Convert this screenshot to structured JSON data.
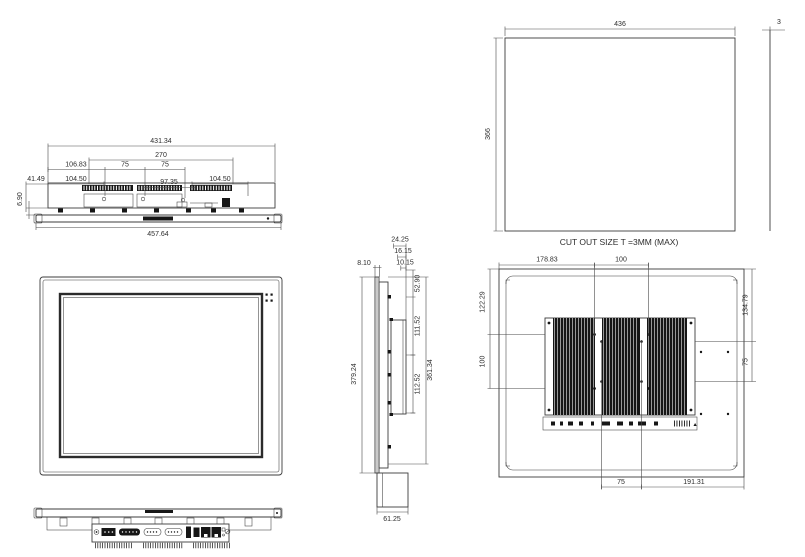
{
  "drawing": {
    "kind": "panel-pc-dimension-drawing",
    "units": "mm",
    "line_color": "#3c3c3c",
    "dark_fill": "#161616",
    "background": "#ffffff"
  },
  "views": {
    "top": {
      "dims": {
        "body_width": "431.34",
        "mount_span": "270",
        "offset_left": "106.83",
        "pitch_a": "75",
        "pitch_b": "75",
        "edge_left": "41.49",
        "seg_left": "104.50",
        "seg_mid": "97.35",
        "seg_right": "104.50",
        "lip": "6.90",
        "overall_width": "457.64"
      }
    },
    "cutout": {
      "caption": "CUT OUT SIZE T =3MM (MAX)",
      "dims": {
        "width": "436",
        "height": "366",
        "thickness": "3"
      }
    },
    "side": {
      "dims": {
        "depth_a": "24.25",
        "depth_b": "16.15",
        "depth_c": "10.15",
        "front_thickness": "8.10",
        "overall_height": "379.24",
        "seg_top": "52.90",
        "seg_mid": "111.52",
        "inner_height": "361.34",
        "seg_bottom": "112.52",
        "bracket_width": "61.25"
      }
    },
    "rear": {
      "dims": {
        "offset_left": "178.83",
        "vesa100_w": "100",
        "offset_top_left": "122.29",
        "vesa100_h": "100",
        "offset_top_right": "134.79",
        "vesa75_h": "75",
        "vesa75_w": "75",
        "offset_bottom_right": "191.31"
      }
    }
  }
}
